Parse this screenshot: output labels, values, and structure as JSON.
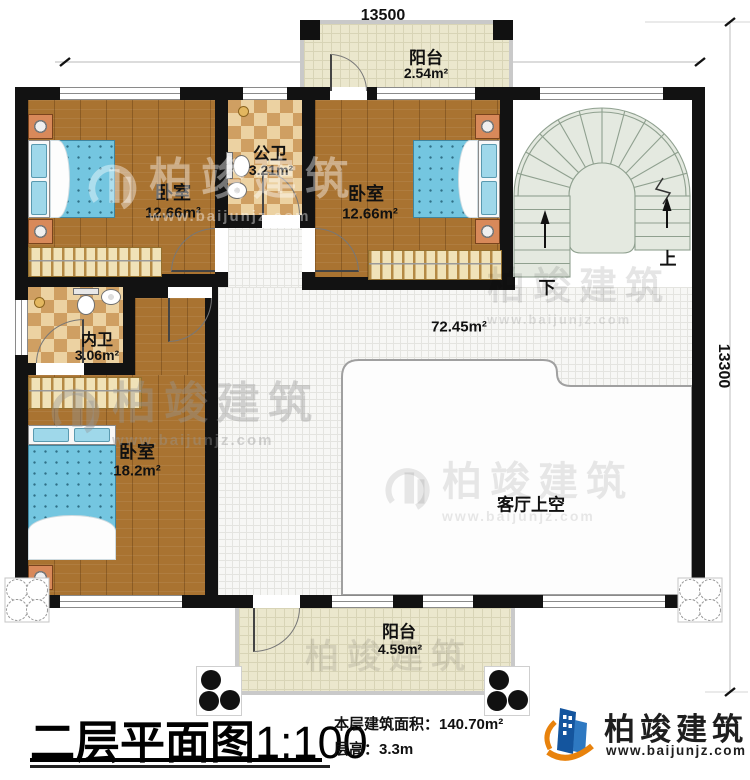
{
  "dimensions": {
    "top": "13500",
    "right": "13300"
  },
  "rooms": {
    "balcony_top": {
      "name": "阳台",
      "area": "2.54m²"
    },
    "bedroom1": {
      "name": "卧室",
      "area": "12.66m²"
    },
    "public_bath": {
      "name": "公卫",
      "area": "3.21m²"
    },
    "bedroom2": {
      "name": "卧室",
      "area": "12.66m²"
    },
    "private_bath": {
      "name": "内卫",
      "area": "3.06m²"
    },
    "bedroom3": {
      "name": "卧室",
      "area": "18.2m²"
    },
    "hall": {
      "area": "72.45m²"
    },
    "living_void": {
      "name": "客厅上空"
    },
    "balcony_bottom": {
      "name": "阳台",
      "area": "4.59m²"
    }
  },
  "stairs": {
    "up_label": "上",
    "down_label": "下"
  },
  "titleblock": {
    "title": "二层平面图",
    "scale": "1:100",
    "floor_area": "本层建筑面积：140.70m²",
    "floor_height": "层高：3.3m"
  },
  "brand": {
    "name": "柏竣建筑",
    "website": "www.baijunjz.com"
  },
  "watermark": {
    "name": "柏竣建筑",
    "website": "www.baijunjz.com"
  },
  "colors": {
    "wall": "#121212",
    "wood_floor": "#a97331",
    "bath_tile": "#cf9f62",
    "balcony_tile": "#ebe7cd",
    "stair_fill": "#e4e9e0",
    "mattress_blue": "#74c6e0",
    "brand_blue": "#14559e",
    "brand_orange": "#e8820c"
  }
}
